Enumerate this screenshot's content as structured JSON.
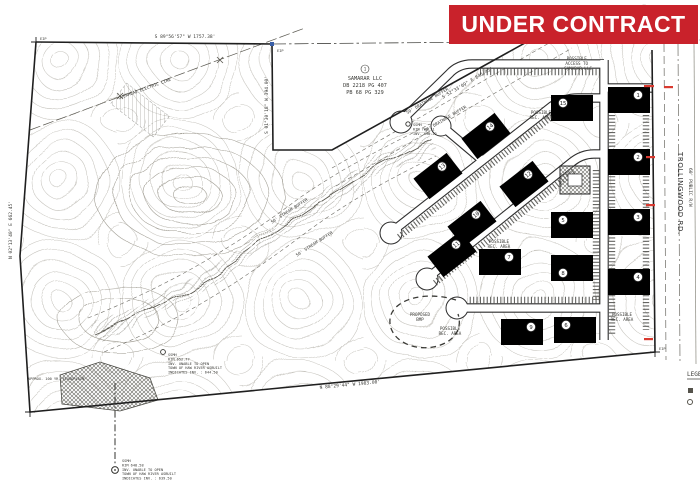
{
  "banner": {
    "label": "UNDER CONTRACT",
    "bg_color": "#c9222b",
    "text_color": "#ffffff"
  },
  "adjoiner": {
    "circle": "1",
    "name": "SAMARAR LLC",
    "deed": "DB 2218 PG 407",
    "plat": "PB 68 PG 329"
  },
  "road": {
    "name": "TROLLINGWOOD RD.",
    "rw": "60' PUBLIC R/W"
  },
  "legend": {
    "title": "LEGEND"
  },
  "bearings": {
    "top": "S 89°56'57\" W  1757.38'",
    "left": "N 02°13'40\" E  662.45'",
    "notch": "S 01°30'18\" W  394.00'",
    "diagonal": "S 52°33'09\" E  845.45'",
    "bottom": "N 88°29'44\" W  1983.00'"
  },
  "labels": {
    "access1": "POSSIBLE",
    "access2": "ACCESS TO",
    "access3": "SAMARAR LLC",
    "rec1": "POSSIBLE",
    "rec2": "REC. AREA",
    "bmp1": "PROPOSED",
    "bmp2": "BMP",
    "drainage_buffer": "50' DRAINAGE BUFFER",
    "stream_buffer": "50' STREAM BUFFER",
    "floodplain": "APPROX. 100 YR. FLOODPLAIN",
    "overhead": "OVERHEAD ELECTRIC LINE",
    "eip": "EIP"
  },
  "notes": {
    "ssmh_mid": [
      "SSMH",
      "RIM 708.31",
      "INV. 698.72"
    ],
    "ssmh_low": [
      "SSMH",
      "RIM 652.77",
      "INV. UNABLE TO OPEN",
      "TOWN OF HAW RIVER ASBUILT",
      "INDICATES INV. : 644.50"
    ],
    "ssmh_bottom": [
      "SSMH",
      "RIM 648.58",
      "INV. UNABLE TO OPEN",
      "TOWN OF HAW RIVER ASBUILT",
      "INDICATES INV. : 639.50"
    ]
  },
  "plan": {
    "building_numbers": [
      "1",
      "2",
      "3",
      "4",
      "15",
      "5",
      "8",
      "6",
      "14",
      "13",
      "12",
      "10",
      "11",
      "7",
      "9"
    ]
  }
}
